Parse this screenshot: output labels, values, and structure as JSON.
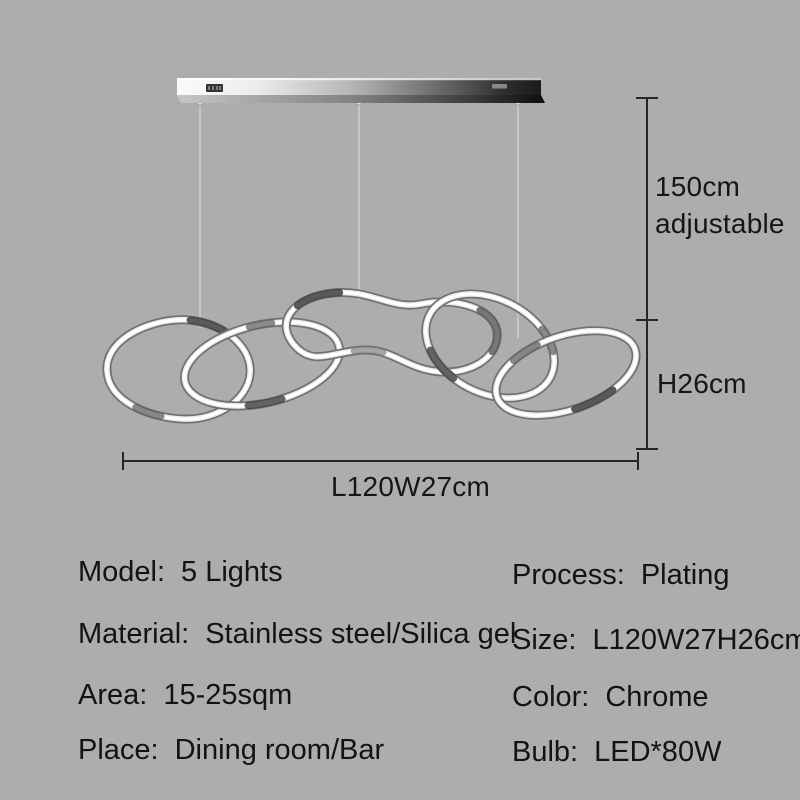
{
  "figure": {
    "description": "Five interlocked free-form chrome LED rings hanging from a chrome ceiling bar by three cables",
    "ring_count": 5,
    "cable_count": 3
  },
  "dimensions": {
    "drop": {
      "line1": "150cm",
      "line2": "adjustable"
    },
    "height": "H26cm",
    "length": "L120W27cm"
  },
  "specs": {
    "left": [
      {
        "label": "Model:",
        "value": "5 Lights"
      },
      {
        "label": "Material:",
        "value": "Stainless steel/Silica gel"
      },
      {
        "label": "Area:",
        "value": "15-25sqm"
      },
      {
        "label": "Place:",
        "value": "Dining room/Bar"
      }
    ],
    "right": [
      {
        "label": "Process:",
        "value": "Plating"
      },
      {
        "label": "Size:",
        "value": "L120W27H26cm"
      },
      {
        "label": "Color:",
        "value": "Chrome"
      },
      {
        "label": "Bulb:",
        "value": "LED*80W"
      }
    ]
  },
  "colors": {
    "background": "#adadad",
    "dimension_line": "#262626",
    "text": "#131313",
    "chrome_light": "#f2f2f2",
    "chrome_dark": "#1b1b1b",
    "ring_core": "#ffffff",
    "cable": "#cccccc"
  }
}
